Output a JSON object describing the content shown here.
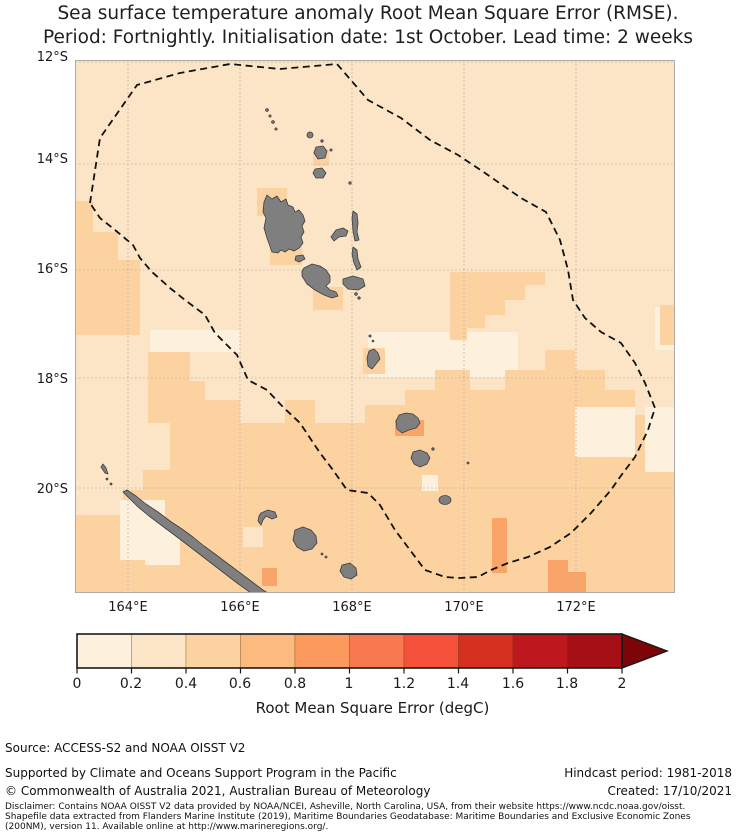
{
  "title": {
    "line1": "Sea surface temperature anomaly Root Mean Square Error (RMSE).",
    "line2": "Period: Fortnightly. Initialisation date: 1st October. Lead time: 2 weeks"
  },
  "map": {
    "y_ticks": [
      "12°S",
      "14°S",
      "16°S",
      "18°S",
      "20°S"
    ],
    "x_ticks": [
      "164°E",
      "166°E",
      "168°E",
      "170°E",
      "172°E"
    ],
    "colors": {
      "base": "#fce5c6",
      "bin1": "#fdf0dd",
      "bin3": "#fcd2a0",
      "bin4": "#f9a468",
      "island_fill": "#7f7f7f",
      "island_stroke": "#3d3d3d",
      "eez": "#111111",
      "grid": "#b5ac9f",
      "border": "#aaaaaa"
    }
  },
  "colorbar": {
    "ticks": [
      "0",
      "0.2",
      "0.4",
      "0.6",
      "0.8",
      "1",
      "1.2",
      "1.4",
      "1.6",
      "1.8",
      "2"
    ],
    "label": "Root Mean Square Error (degC)",
    "colors": [
      "#fdf0dd",
      "#fce5c6",
      "#fcd2a0",
      "#fcba7e",
      "#fb9a5c",
      "#f87950",
      "#f6513a",
      "#d63020",
      "#bc181d",
      "#a60f15"
    ],
    "arrow_color": "#7d0508",
    "outline": "#1a1a1a"
  },
  "footer": {
    "source": "Source: ACCESS-S2 and NOAA OISST V2",
    "supported": "Supported by Climate and Oceans Support Program in the Pacific",
    "copyright": "© Commonwealth of Australia 2021, Australian Bureau of Meteorology",
    "hindcast": "Hindcast period: 1981-2018",
    "created": "Created: 17/10/2021",
    "disclaimer_l1": "Disclaimer: Contains NOAA OISST V2 data provided by NOAA/NCEI, Asheville, North Carolina, USA, from their website https://www.ncdc.noaa.gov/oisst.",
    "disclaimer_l2": "Shapefile data extracted from Flanders Marine Institute (2019), Maritime Boundaries Geodatabase: Maritime Boundaries and Exclusive Economic Zones",
    "disclaimer_l3": "(200NM), version 11. Available online at http://www.marineregions.org/."
  }
}
